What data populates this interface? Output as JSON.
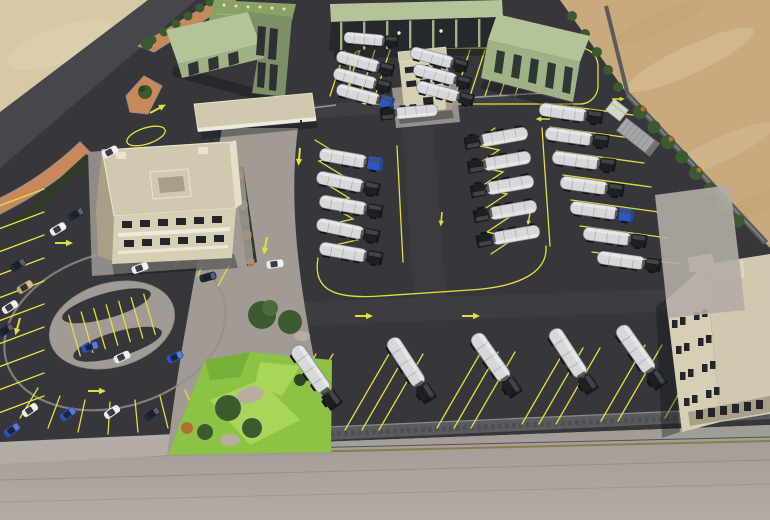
{
  "meta": {
    "type": "3d-architectural-render",
    "view": "aerial-three-quarter",
    "subject": "tanker-truck depot with offices, warehouses, car parking loop and desert surroundings"
  },
  "palette": {
    "sand_light": "#d7c8a6",
    "sand_warm": "#c9aa7d",
    "asphalt": "#37373b",
    "asphalt_road": "#46464b",
    "concrete": "#a19a95",
    "concrete_light": "#b3aca6",
    "curb": "#94908b",
    "orange_median": "#c8885a",
    "wall_gray": "#5b5b5f",
    "hedge_dark": "#2f3a27",
    "green_wall": "#9fb286",
    "green_roof": "#b3c49a",
    "green_roof_dotted": "#87a263",
    "dark_interior": "#26292c",
    "beige_wall": "#d6cfb4",
    "beige_shadow": "#a89f86",
    "beige_roof": "#d0c9ae",
    "window_dark": "#23252a",
    "marking_yellow": "#e3de3f",
    "grass": "#8cc344",
    "grass_light": "#a7d65b",
    "grass_dark": "#76b038",
    "tree_green": "#3c5a30",
    "tree_orange": "#b06f2c",
    "rock": "#b7aea0",
    "tank_white": "#d7d8da",
    "cab_dark": "#1d1f22",
    "truck_blue": "#2b57c8",
    "car_blue": "#2a52c0",
    "car_white": "#ececef",
    "car_navy": "#20283c",
    "car_tan": "#c3a96c",
    "white_trim": "#efece2",
    "road_line_olive": "#7a7a3a"
  },
  "scene": {
    "ground": {
      "left_desert": "light sand",
      "right_desert": "warm sand with wind streaks",
      "yard": "dark asphalt truck yard",
      "south_road": "concrete road across bottom"
    },
    "buildings": [
      {
        "id": "warehouse-dotted-roof",
        "label": "green warehouse with rooftop vents"
      },
      {
        "id": "warehouse-west",
        "label": "green warehouse with dark loading bays"
      },
      {
        "id": "loading-canopy",
        "label": "open loading canopy with six bays"
      },
      {
        "id": "warehouse-northeast",
        "label": "green warehouse, rotated, dark bays"
      },
      {
        "id": "gate-office",
        "label": "two-storey cream gate office"
      },
      {
        "id": "entrance-canopy",
        "label": "flat entrance canopy near office"
      },
      {
        "id": "main-office",
        "label": "two-storey office with rooftop court and awnings"
      },
      {
        "id": "southeast-building",
        "label": "large cream building with paired windows"
      },
      {
        "id": "shipping-container",
        "label": "gray shipping container"
      },
      {
        "id": "utility-cabin",
        "label": "pale utility cabin"
      }
    ],
    "vehicles": {
      "tanker_trucks": 30,
      "cars": 18,
      "blue_cab_trucks": 3,
      "truck_description": "white segmented tank trailers with dark cabs"
    },
    "markings": {
      "color_name": "yellow",
      "arrows": 12,
      "parking_styles": [
        "herringbone zig-zag truck bays (center)",
        "angled car bays (west edge and loop)",
        "straight truck bays (east and south rows)"
      ]
    },
    "landscape": {
      "garden": "lawn with trees and rocks at south-center",
      "perimeter_trees": 13,
      "shrub_row": 7,
      "h_island": "H-shaped gray paved island inside the car parking loop",
      "orange_medians": "terracotta median islands at the west entrance"
    }
  }
}
